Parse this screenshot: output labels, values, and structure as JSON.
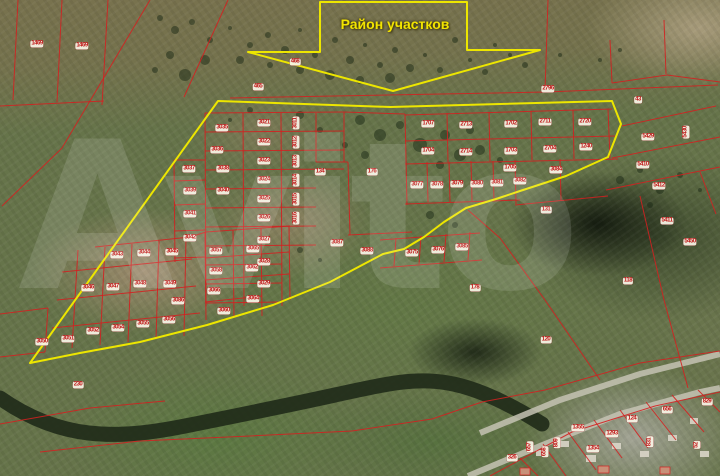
{
  "callout": {
    "label": "Район участков"
  },
  "watermark": {
    "text": "Avito"
  },
  "map": {
    "colors": {
      "yellow": "#ede600",
      "red": "#d42020",
      "label_text": "#c01818",
      "river": "#1f2a18",
      "road": "#c6c3b4",
      "house": "#d9d5c8",
      "red_house": "#c89078",
      "forest": "#1c2a16"
    },
    "region_outline": [
      [
        218,
        101
      ],
      [
        390,
        107
      ],
      [
        612,
        101
      ],
      [
        621,
        124
      ],
      [
        608,
        157
      ],
      [
        566,
        176
      ],
      [
        520,
        191
      ],
      [
        496,
        199
      ],
      [
        466,
        208
      ],
      [
        444,
        222
      ],
      [
        424,
        237
      ],
      [
        404,
        249
      ],
      [
        383,
        254
      ],
      [
        330,
        282
      ],
      [
        273,
        305
      ],
      [
        207,
        325
      ],
      [
        140,
        342
      ],
      [
        80,
        353
      ],
      [
        30,
        363
      ]
    ],
    "callout_arrow": [
      [
        320,
        2
      ],
      [
        467,
        2
      ],
      [
        467,
        50
      ],
      [
        540,
        50
      ],
      [
        393,
        91
      ],
      [
        248,
        52
      ],
      [
        320,
        52
      ]
    ],
    "river_path": "M0,398 C60,440 115,440 185,426 C255,412 285,406 335,395 C385,384 415,377 448,383 C478,388 510,404 542,424",
    "roads": [
      [
        468,
        476,
        540,
        446,
        620,
        414,
        700,
        392,
        720,
        388
      ],
      [
        480,
        433,
        560,
        400,
        640,
        374,
        720,
        354
      ]
    ],
    "houses": [
      [
        536,
        450,
        9,
        6
      ],
      [
        560,
        441,
        9,
        6
      ],
      [
        586,
        455,
        10,
        7
      ],
      [
        612,
        443,
        9,
        6
      ],
      [
        640,
        451,
        9,
        6
      ],
      [
        668,
        435,
        9,
        6
      ],
      [
        700,
        451,
        9,
        6
      ],
      [
        690,
        418,
        8,
        6
      ]
    ],
    "red_houses": [
      [
        520,
        468,
        10,
        7
      ],
      [
        598,
        466,
        11,
        7
      ],
      [
        660,
        467,
        10,
        7
      ]
    ],
    "forest_dots": [
      [
        160,
        18,
        3
      ],
      [
        175,
        30,
        4
      ],
      [
        192,
        22,
        3
      ],
      [
        210,
        40,
        3
      ],
      [
        230,
        28,
        2
      ],
      [
        250,
        45,
        3
      ],
      [
        268,
        35,
        3
      ],
      [
        285,
        50,
        4
      ],
      [
        300,
        30,
        2
      ],
      [
        315,
        55,
        3
      ],
      [
        335,
        40,
        3
      ],
      [
        350,
        60,
        4
      ],
      [
        365,
        45,
        2
      ],
      [
        380,
        65,
        3
      ],
      [
        395,
        50,
        3
      ],
      [
        410,
        68,
        4
      ],
      [
        425,
        55,
        2
      ],
      [
        440,
        70,
        3
      ],
      [
        455,
        40,
        3
      ],
      [
        470,
        60,
        2
      ],
      [
        485,
        72,
        3
      ],
      [
        330,
        75,
        5
      ],
      [
        360,
        80,
        4
      ],
      [
        390,
        78,
        5
      ],
      [
        300,
        70,
        4
      ],
      [
        270,
        65,
        3
      ],
      [
        240,
        60,
        4
      ],
      [
        205,
        60,
        5
      ],
      [
        185,
        75,
        6
      ],
      [
        170,
        55,
        4
      ],
      [
        155,
        70,
        3
      ],
      [
        510,
        55,
        2
      ],
      [
        525,
        65,
        3
      ],
      [
        495,
        45,
        2
      ],
      [
        560,
        55,
        2
      ],
      [
        600,
        60,
        2
      ],
      [
        620,
        50,
        2
      ],
      [
        360,
        120,
        5
      ],
      [
        380,
        135,
        6
      ],
      [
        400,
        125,
        4
      ],
      [
        420,
        145,
        7
      ],
      [
        445,
        135,
        5
      ],
      [
        460,
        155,
        6
      ],
      [
        440,
        165,
        4
      ],
      [
        300,
        115,
        4
      ],
      [
        320,
        130,
        3
      ],
      [
        250,
        110,
        3
      ],
      [
        230,
        120,
        2
      ],
      [
        480,
        150,
        5
      ],
      [
        470,
        130,
        4
      ],
      [
        500,
        160,
        3
      ],
      [
        365,
        155,
        4
      ],
      [
        345,
        145,
        3
      ],
      [
        430,
        215,
        4
      ],
      [
        455,
        225,
        3
      ],
      [
        300,
        250,
        3
      ],
      [
        320,
        260,
        2
      ],
      [
        620,
        180,
        4
      ],
      [
        640,
        170,
        3
      ],
      [
        660,
        190,
        4
      ],
      [
        680,
        175,
        3
      ],
      [
        700,
        190,
        2
      ],
      [
        650,
        205,
        3
      ]
    ],
    "red_lines": [
      [
        18,
        0,
        13,
        100
      ],
      [
        62,
        0,
        57,
        102
      ],
      [
        108,
        0,
        102,
        105
      ],
      [
        0,
        106,
        104,
        101
      ],
      [
        150,
        0,
        62,
        148
      ],
      [
        62,
        148,
        2,
        206
      ],
      [
        228,
        0,
        184,
        97
      ],
      [
        230,
        98,
        546,
        92
      ],
      [
        546,
        92,
        718,
        85
      ],
      [
        548,
        0,
        545,
        91
      ],
      [
        610,
        40,
        612,
        83
      ],
      [
        612,
        83,
        667,
        75
      ],
      [
        667,
        75,
        720,
        82
      ],
      [
        664,
        20,
        666,
        74
      ],
      [
        205,
        113,
        206,
        306
      ],
      [
        243,
        113,
        244,
        306
      ],
      [
        281,
        113,
        282,
        306
      ],
      [
        316,
        113,
        316,
        162
      ],
      [
        344,
        112,
        344,
        162
      ],
      [
        348,
        162,
        350,
        235
      ],
      [
        205,
        113,
        344,
        112
      ],
      [
        205,
        132,
        344,
        131
      ],
      [
        205,
        151,
        344,
        150
      ],
      [
        205,
        170,
        344,
        169
      ],
      [
        205,
        189,
        316,
        188
      ],
      [
        205,
        208,
        316,
        207
      ],
      [
        205,
        227,
        316,
        226
      ],
      [
        206,
        246,
        316,
        245
      ],
      [
        206,
        265,
        282,
        264
      ],
      [
        206,
        284,
        282,
        283
      ],
      [
        206,
        303,
        282,
        302
      ],
      [
        174,
        160,
        175,
        262
      ],
      [
        174,
        160,
        205,
        160
      ],
      [
        174,
        181,
        205,
        180
      ],
      [
        174,
        205,
        205,
        204
      ],
      [
        174,
        231,
        205,
        230
      ],
      [
        174,
        258,
        206,
        257
      ],
      [
        344,
        112,
        405,
        114
      ],
      [
        316,
        162,
        348,
        162
      ],
      [
        348,
        235,
        412,
        232
      ],
      [
        405,
        115,
        612,
        109
      ],
      [
        405,
        141,
        615,
        136
      ],
      [
        405,
        164,
        618,
        159
      ],
      [
        405,
        204,
        520,
        200
      ],
      [
        515,
        205,
        608,
        196
      ],
      [
        405,
        114,
        407,
        205
      ],
      [
        447,
        113,
        448,
        162
      ],
      [
        489,
        112,
        490,
        161
      ],
      [
        531,
        111,
        532,
        160
      ],
      [
        573,
        110,
        574,
        159
      ],
      [
        608,
        109,
        610,
        158
      ],
      [
        427,
        162,
        428,
        202
      ],
      [
        449,
        162,
        450,
        202
      ],
      [
        471,
        161,
        472,
        201
      ],
      [
        493,
        161,
        494,
        201
      ],
      [
        515,
        160,
        516,
        204
      ],
      [
        560,
        159,
        561,
        200
      ],
      [
        380,
        240,
        480,
        233
      ],
      [
        380,
        268,
        482,
        260
      ],
      [
        396,
        238,
        394,
        266
      ],
      [
        421,
        236,
        419,
        264
      ],
      [
        446,
        234,
        444,
        262
      ],
      [
        470,
        232,
        468,
        260
      ],
      [
        95,
        247,
        190,
        237
      ],
      [
        62,
        272,
        192,
        259
      ],
      [
        57,
        300,
        196,
        286
      ],
      [
        52,
        328,
        200,
        313
      ],
      [
        78,
        250,
        72,
        348
      ],
      [
        105,
        247,
        100,
        345
      ],
      [
        132,
        244,
        128,
        342
      ],
      [
        159,
        241,
        156,
        339
      ],
      [
        186,
        238,
        184,
        336
      ],
      [
        205,
        232,
        206,
        320
      ],
      [
        233,
        230,
        234,
        318
      ],
      [
        261,
        228,
        262,
        316
      ],
      [
        289,
        226,
        290,
        300
      ],
      [
        206,
        232,
        290,
        226
      ],
      [
        205,
        258,
        289,
        252
      ],
      [
        205,
        280,
        289,
        274
      ],
      [
        205,
        302,
        262,
        296
      ],
      [
        190,
        237,
        206,
        232
      ],
      [
        0,
        314,
        48,
        308
      ],
      [
        48,
        308,
        45,
        352
      ],
      [
        0,
        357,
        45,
        352
      ],
      [
        622,
        126,
        716,
        106
      ],
      [
        612,
        158,
        720,
        137
      ],
      [
        606,
        190,
        720,
        167
      ],
      [
        640,
        196,
        664,
        300
      ],
      [
        664,
        300,
        688,
        388
      ],
      [
        700,
        172,
        716,
        214
      ],
      [
        545,
        390,
        640,
        363
      ],
      [
        640,
        363,
        720,
        351
      ],
      [
        490,
        476,
        572,
        432
      ],
      [
        572,
        432,
        655,
        406
      ],
      [
        655,
        406,
        720,
        392
      ],
      [
        520,
        458,
        538,
        476
      ],
      [
        543,
        444,
        566,
        476
      ],
      [
        568,
        432,
        596,
        470
      ],
      [
        594,
        420,
        622,
        458
      ],
      [
        620,
        410,
        648,
        448
      ],
      [
        646,
        402,
        676,
        440
      ],
      [
        672,
        395,
        704,
        432
      ],
      [
        698,
        390,
        720,
        412
      ],
      [
        0,
        424,
        90,
        408
      ],
      [
        90,
        408,
        165,
        401
      ],
      [
        40,
        452,
        140,
        441
      ],
      [
        140,
        441,
        250,
        436
      ],
      [
        250,
        436,
        352,
        431
      ],
      [
        352,
        431,
        432,
        419
      ],
      [
        432,
        419,
        482,
        402
      ],
      [
        482,
        402,
        545,
        390
      ],
      [
        468,
        210,
        500,
        238
      ],
      [
        500,
        238,
        545,
        300
      ],
      [
        545,
        300,
        600,
        380
      ]
    ],
    "parcels": [
      [
        "1469",
        37,
        44
      ],
      [
        "1469",
        82,
        46
      ],
      [
        "468",
        295,
        62
      ],
      [
        "465",
        258,
        87
      ],
      [
        "2796",
        548,
        89
      ],
      [
        "43",
        638,
        100
      ],
      [
        "1707",
        428,
        124
      ],
      [
        "2713",
        466,
        125
      ],
      [
        "1702",
        511,
        124
      ],
      [
        "2711",
        545,
        122
      ],
      [
        "2720",
        585,
        122
      ],
      [
        "1704",
        428,
        151
      ],
      [
        "2714",
        466,
        152
      ],
      [
        "1703",
        511,
        151
      ],
      [
        "2704",
        550,
        149
      ],
      [
        "1240",
        586,
        147
      ],
      [
        "1705",
        510,
        168
      ],
      [
        "3077",
        417,
        185
      ],
      [
        "3078",
        437,
        185
      ],
      [
        "3079",
        457,
        184
      ],
      [
        "3080",
        477,
        184
      ],
      [
        "3081",
        497,
        183
      ],
      [
        "3082",
        520,
        181
      ],
      [
        "3084",
        556,
        170
      ],
      [
        "134",
        320,
        172
      ],
      [
        "176",
        372,
        172
      ],
      [
        "131",
        546,
        210
      ],
      [
        "178",
        475,
        288
      ],
      [
        "120",
        546,
        340
      ],
      [
        "118",
        628,
        281
      ],
      [
        "230",
        78,
        385
      ],
      [
        "3021",
        264,
        123
      ],
      [
        "3022",
        264,
        142
      ],
      [
        "3023",
        264,
        161
      ],
      [
        "3024",
        264,
        180
      ],
      [
        "3025",
        264,
        199
      ],
      [
        "3026",
        264,
        218
      ],
      [
        "3027",
        264,
        240
      ],
      [
        "3028",
        264,
        262
      ],
      [
        "3029",
        264,
        284
      ],
      [
        "3011",
        296,
        123,
        1
      ],
      [
        "3012",
        296,
        142,
        1
      ],
      [
        "3013",
        296,
        161,
        1
      ],
      [
        "3014",
        296,
        180,
        1
      ],
      [
        "3015",
        296,
        199,
        1
      ],
      [
        "3016",
        296,
        218,
        1
      ],
      [
        "3035",
        222,
        128
      ],
      [
        "3036",
        217,
        150
      ],
      [
        "3037",
        189,
        169
      ],
      [
        "3038",
        223,
        169
      ],
      [
        "3039",
        190,
        191
      ],
      [
        "3040",
        223,
        191
      ],
      [
        "3041",
        190,
        214
      ],
      [
        "3042",
        190,
        238
      ],
      [
        "3087",
        337,
        243
      ],
      [
        "3088",
        367,
        251
      ],
      [
        "3075",
        412,
        253
      ],
      [
        "3076",
        438,
        250
      ],
      [
        "3085",
        462,
        247
      ],
      [
        "3043",
        117,
        255
      ],
      [
        "3044",
        144,
        253
      ],
      [
        "3045",
        172,
        252
      ],
      [
        "3046",
        88,
        288
      ],
      [
        "3047",
        113,
        287
      ],
      [
        "3048",
        140,
        284
      ],
      [
        "3049",
        170,
        284
      ],
      [
        "3086",
        178,
        301
      ],
      [
        "3050",
        42,
        342
      ],
      [
        "3051",
        68,
        339
      ],
      [
        "3052",
        93,
        331
      ],
      [
        "3054",
        118,
        328
      ],
      [
        "3055",
        143,
        324
      ],
      [
        "3056",
        169,
        320
      ],
      [
        "3057",
        216,
        251
      ],
      [
        "3065",
        253,
        249
      ],
      [
        "3058",
        216,
        271
      ],
      [
        "3062",
        252,
        268
      ],
      [
        "3066",
        214,
        291
      ],
      [
        "3064",
        253,
        299
      ],
      [
        "3060",
        224,
        311
      ],
      [
        "5429",
        648,
        137
      ],
      [
        "5430",
        686,
        132,
        1
      ],
      [
        "5410",
        643,
        165
      ],
      [
        "5412",
        659,
        186
      ],
      [
        "5411",
        667,
        221
      ],
      [
        "5450",
        690,
        242
      ],
      [
        "326",
        512,
        458
      ],
      [
        "657",
        530,
        447,
        1
      ],
      [
        "658",
        545,
        452,
        1
      ],
      [
        "809",
        557,
        443,
        1
      ],
      [
        "1355",
        578,
        428
      ],
      [
        "1354",
        593,
        449
      ],
      [
        "1293",
        612,
        434
      ],
      [
        "124",
        632,
        419
      ],
      [
        "656",
        667,
        410
      ],
      [
        "829",
        707,
        402
      ],
      [
        "831",
        650,
        442,
        1
      ],
      [
        "52",
        697,
        445,
        1
      ]
    ]
  }
}
